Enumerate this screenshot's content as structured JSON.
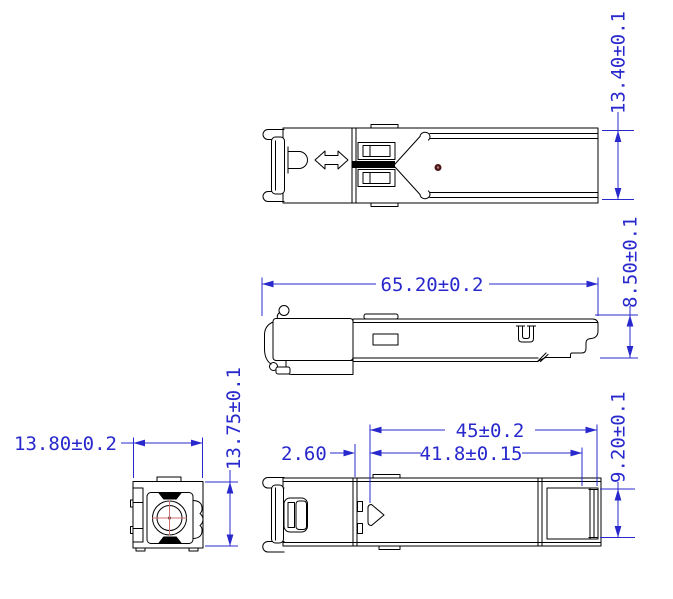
{
  "drawing": {
    "type": "mechanical-engineering-drawing",
    "subject": "SFP transceiver module, four orthographic views"
  },
  "dimensions": {
    "overall_height": "13.40±0.1",
    "overall_length": "65.20±0.2",
    "body_height": "8.50±0.1",
    "front_width": "13.80±0.2",
    "front_height": "13.75±0.1",
    "edge_offset": "2.60",
    "pcb_length": "45±0.2",
    "connector_length": "41.8±0.15",
    "connector_height": "9.20±0.1"
  },
  "icons": {
    "bail_direction": "double-arrow",
    "orientation_marker": "right-pointing-triangle",
    "marking_dot": "small-maroon-dot"
  },
  "colors": {
    "line": "#000000",
    "dimension": "#2828cc",
    "crosshair": "#cc7070",
    "dot_outer": "#4a1818",
    "dot_inner": "#bb7777",
    "background": "#ffffff"
  }
}
